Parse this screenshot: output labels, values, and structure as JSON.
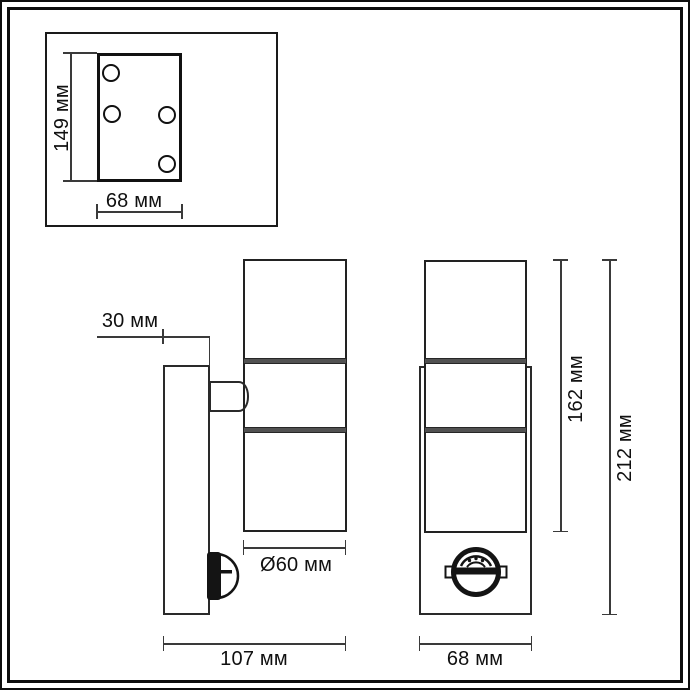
{
  "drawing_type": "luminaire technical dimension drawing",
  "colors": {
    "line": "#222222",
    "dim_line": "#3a3a3a",
    "band": "#515151",
    "background": "#ffffff"
  },
  "inset": {
    "height_label": "149 мм",
    "width_label": "68 мм",
    "holes_count": 4
  },
  "side_view": {
    "depth_label": "30 мм",
    "diameter_label": "Ø60 мм",
    "total_depth_label": "107 мм"
  },
  "front_view": {
    "body_height_label": "162 мм",
    "total_height_label": "212 мм",
    "width_label": "68 мм"
  }
}
